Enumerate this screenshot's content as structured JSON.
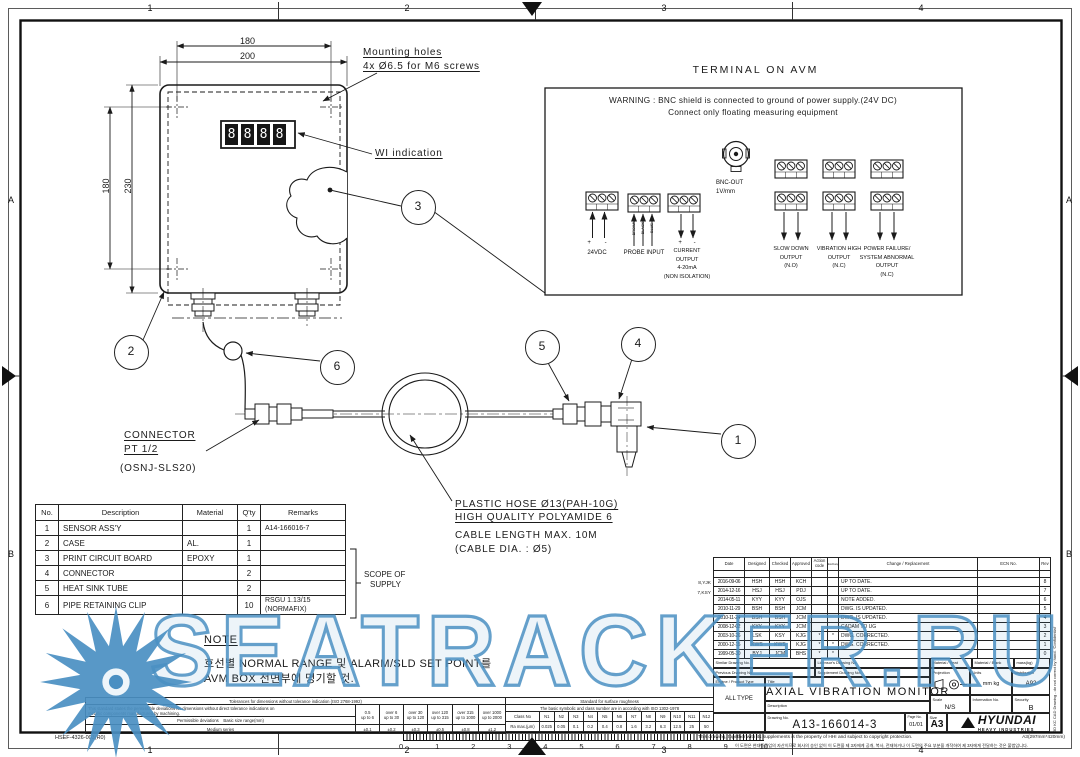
{
  "sheet": {
    "zones_h": [
      "1",
      "2",
      "3",
      "4"
    ],
    "zones_v": [
      "A",
      "B"
    ],
    "form_code": "HSEF-4326-003(R0)"
  },
  "watermark": {
    "text": "SEATRACKER.RU",
    "color": "#4a8fc2"
  },
  "avm_view": {
    "dim_inner_width": "180",
    "dim_outer_width": "200",
    "dim_inner_height": "180",
    "dim_outer_height": "230",
    "mounting_note_1": "Mounting holes",
    "mounting_note_2": "4x Ø6.5 for M6 screws",
    "wi_label": "WI indication",
    "display_digits": [
      "8",
      "8",
      "8",
      "8"
    ]
  },
  "balloons": {
    "b1": "1",
    "b2": "2",
    "b3": "3",
    "b4": "4",
    "b5": "5",
    "b6": "6"
  },
  "assembly": {
    "connector_line1": "CONNECTOR",
    "connector_line2": "PT 1/2",
    "connector_line3": "(OSNJ-SLS20)",
    "hose_line1": "PLASTIC HOSE Ø13(PAH-10G)",
    "hose_line2": "HIGH QUALITY POLYAMIDE 6",
    "cable_line1": "CABLE LENGTH MAX. 10M",
    "cable_line2": "(CABLE DIA. : Ø5)"
  },
  "terminal_panel": {
    "title": "TERMINAL ON AVM",
    "warning_line1": "WARNING : BNC shield is connected to ground of power supply.(24V DC)",
    "warning_line2": "Connect only floating measuring equipment",
    "bnc_line1": "BNC-OUT",
    "bnc_line2": "1V/mm",
    "group_24vdc": {
      "polarity": "+ -",
      "label": "24VDC"
    },
    "group_probe": {
      "label": "PROBE INPUT",
      "wires": [
        "BROWN",
        "BLACK",
        "BLUE"
      ]
    },
    "group_current": {
      "polarity": "+ -",
      "lines": [
        "CURRENT",
        "OUTPUT",
        "4-20mA",
        "(NON ISOLATION)"
      ]
    },
    "group_slowdown": {
      "lines": [
        "SLOW DOWN",
        "OUTPUT",
        "(N.O)"
      ]
    },
    "group_vibration": {
      "lines": [
        "VIBRATION HIGH",
        "OUTPUT",
        "(N.C)"
      ]
    },
    "group_power": {
      "lines": [
        "POWER FAILURE/",
        "SYSTEM ABNORMAL",
        "OUTPUT",
        "(N.C)"
      ]
    }
  },
  "parts_table": {
    "headers": [
      "No.",
      "Description",
      "Material",
      "Q'ty",
      "Remarks"
    ],
    "rows": [
      {
        "no": "1",
        "desc": "SENSOR ASS'Y",
        "mat": "",
        "qty": "1",
        "rem": "A14-166016-7"
      },
      {
        "no": "2",
        "desc": "CASE",
        "mat": "AL.",
        "qty": "1",
        "rem": ""
      },
      {
        "no": "3",
        "desc": "PRINT CIRCUIT BOARD",
        "mat": "EPOXY",
        "qty": "1",
        "rem": ""
      },
      {
        "no": "4",
        "desc": "CONNECTOR",
        "mat": "",
        "qty": "2",
        "rem": ""
      },
      {
        "no": "5",
        "desc": "HEAT SINK TUBE",
        "mat": "",
        "qty": "2",
        "rem": ""
      },
      {
        "no": "6",
        "desc": "PIPE RETAINING CLIP",
        "mat": "",
        "qty": "10",
        "rem": "RSGU 1.13/15 (NORMAFIX)"
      }
    ],
    "scope_line1": "SCOPE OF",
    "scope_line2": "SUPPLY"
  },
  "note": {
    "title": "NOTE",
    "line1": "호선별 NORMAL RANGE 및 ALARM/SLD SET POINT를",
    "line2": "AVM BOX 전면부에 명기할 것."
  },
  "tolerance_table": {
    "title": "Tolerances for dimensions without tolerance indication (ISO 2768-1992)",
    "desc1": "This standard states the permissible deviations for dimensions without direct tolerance indications on",
    "desc2": "metallic components manufactured by machining.",
    "row_label": "Permissible deviations",
    "range_label": "Basic size range(mm)",
    "series_label": "Medium series",
    "ranges": [
      {
        "top": "0.5",
        "bottom": "up to 6"
      },
      {
        "top": "over 6",
        "bottom": "up to 30"
      },
      {
        "top": "over 30",
        "bottom": "up to 120"
      },
      {
        "top": "over 120",
        "bottom": "up to 315"
      },
      {
        "top": "over 315",
        "bottom": "up to 1000"
      },
      {
        "top": "over 1000",
        "bottom": "up to 2000"
      }
    ],
    "values": [
      "±0.1",
      "±0.2",
      "±0.3",
      "±0.5",
      "±0.8",
      "±1.2"
    ]
  },
  "roughness_table": {
    "title": "Standard for surface roughness",
    "subtitle": "The basic symbolic and class number are in according with ISO 1302-1978",
    "class_label": "Class No",
    "ra_label": "Ra max.(μm)",
    "classes": [
      "N1",
      "N2",
      "N3",
      "N4",
      "N5",
      "N6",
      "N7",
      "N8",
      "N9",
      "N10",
      "N11",
      "N12"
    ],
    "values": [
      "0.025",
      "0.05",
      "0.1",
      "0.2",
      "0.4",
      "0.8",
      "1.6",
      "3.2",
      "6.3",
      "12.5",
      "25",
      "50"
    ]
  },
  "ruler": {
    "numbers": [
      "0",
      "1",
      "2",
      "3",
      "4",
      "5",
      "6",
      "7",
      "8",
      "9",
      "10"
    ]
  },
  "revision_table": {
    "headers": {
      "date": "Date",
      "designed": "Designed",
      "checked": "Checked",
      "approved": "Approved",
      "action": "Action code",
      "exchange": "Exchangeability",
      "change": "Change / Replacement",
      "ecn": "ECN No.",
      "rev": "Rev"
    },
    "rows": [
      {
        "date": "2016-09-06",
        "des": "HSH",
        "chk": "HSH",
        "app": "KCH",
        "act": "",
        "exc": "",
        "change": "UP TO DATE.",
        "ecn": "",
        "rev": "8"
      },
      {
        "date": "2014-12-16",
        "des": "HSJ",
        "chk": "HSJ",
        "app": "PDJ",
        "act": "",
        "exc": "",
        "change": "UP TO DATE.",
        "ecn": "",
        "rev": "7"
      },
      {
        "date": "2014-05-11",
        "des": "KYY",
        "chk": "KYY",
        "app": "OJS",
        "act": "",
        "exc": "",
        "change": "NOTE ADDED.",
        "ecn": "",
        "rev": "6"
      },
      {
        "date": "2010-11-29",
        "des": "BSH",
        "chk": "BSH",
        "app": "JCM",
        "act": "",
        "exc": "",
        "change": "DWG. IS UPDATED.",
        "ecn": "",
        "rev": "5"
      },
      {
        "date": "2010-11-24",
        "des": "BSH",
        "chk": "BSH",
        "app": "JCM",
        "act": "",
        "exc": "",
        "change": "DWG. IS UPDATED.",
        "ecn": "",
        "rev": "4"
      },
      {
        "date": "2008-12-02",
        "des": "KYY",
        "chk": "KYY",
        "app": "JCM",
        "act": "",
        "exc": "",
        "change": "CADAM TO UG",
        "ecn": "",
        "rev": "3"
      },
      {
        "date": "2003-10-26",
        "des": "LSK",
        "chk": "KSY",
        "app": "KJG",
        "act": "*",
        "exc": "*",
        "change": "DWG. CORRECTED.",
        "ecn": "",
        "rev": "2"
      },
      {
        "date": "2000-12-15",
        "des": "KWS",
        "chk": "KWS",
        "app": "KJG",
        "act": "*",
        "exc": "*",
        "change": "DWG. CORRECTED.",
        "ecn": "",
        "rev": "1"
      },
      {
        "date": "1999-05-30",
        "des": "BYJ",
        "chk": "JCM",
        "app": "BHS",
        "act": "*",
        "exc": "*",
        "change": "",
        "ecn": "",
        "rev": "0"
      }
    ],
    "margin_note_1": "8,YJK",
    "margin_note_2": "7,KSY"
  },
  "title_block": {
    "similar_label": "Similar Drawing No.",
    "licensor_label": "Licensor's Drawing No.",
    "previous_label": "Previous Drawing No.",
    "supplement_label": "Supplement Drawing No.",
    "material_heat_label": "Material / Heat",
    "material_blank_label": "Material / Blank",
    "mass_label": "mass(kg)",
    "engine_label": "Engine / Product Type",
    "engine_value": "ALL TYPE",
    "title_label": "Title",
    "title_value": "AXIAL VIBRATION MONITOR",
    "description_label": "Description",
    "projection_label": "Projection",
    "units_label": "Units",
    "units_value": "mm kg",
    "distribution_label": "Distribution",
    "distribution_value": "A92",
    "scale_label": "Scale",
    "scale_value": "N/S",
    "information_label": "Information No.",
    "security_label": "Security",
    "security_value": "B",
    "drawing_no_label": "Drawing No.",
    "drawing_no_value": "A13-166014-3",
    "page_label": "Page No.",
    "page_value": "01/01",
    "size_label": "Size",
    "size_value": "A3",
    "logo_text": "HYUNDAI",
    "logo_sub": "HEAVY INDUSTRIES"
  },
  "footer": {
    "copyright_en": "This drawing, together with its supplements is the property of HHI and subject to copyright protection.",
    "sheet_size": "A3(297mm*420mm)",
    "copyright_kr": "이 도면은 현대중공업의 자산이므로 회사의 승인 없이 이 도면을 제 3자에게 공개, 복사, 전재하거나 이 도면의 주요 부분을 개작하여 제 3자에게 전달하는 것은 불법입니다.",
    "side_note": "3D KC CAD Drawing - do not correct by hand.  'Confidential'"
  }
}
